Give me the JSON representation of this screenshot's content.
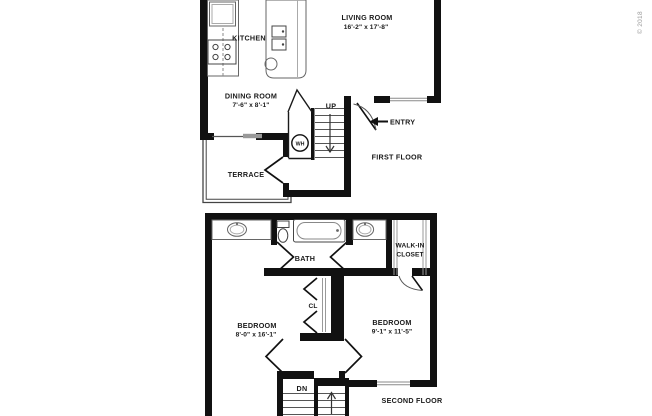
{
  "copyright": "© 2018",
  "first_floor": {
    "title": "FIRST FLOOR",
    "kitchen_label": "KITCHEN",
    "living_room_label": "LIVING ROOM",
    "living_room_dims": "16'-2\" x 17'-8\"",
    "dining_room_label": "DINING ROOM",
    "dining_room_dims": "7'-6\" x 8'-1\"",
    "terrace_label": "TERRACE",
    "entry_label": "ENTRY",
    "stairs_up_label": "UP",
    "water_heater_label": "WH"
  },
  "second_floor": {
    "title": "SECOND FLOOR",
    "bath_label": "BATH",
    "walk_in_closet_line1": "WALK-IN",
    "walk_in_closet_line2": "CLOSET",
    "closet_label": "CL",
    "bedroom_left_label": "BEDROOM",
    "bedroom_left_dims": "8'-0\" x 16'-1\"",
    "bedroom_right_label": "BEDROOM",
    "bedroom_right_dims": "9'-1\" x 11'-5\"",
    "stairs_down_label": "DN"
  }
}
